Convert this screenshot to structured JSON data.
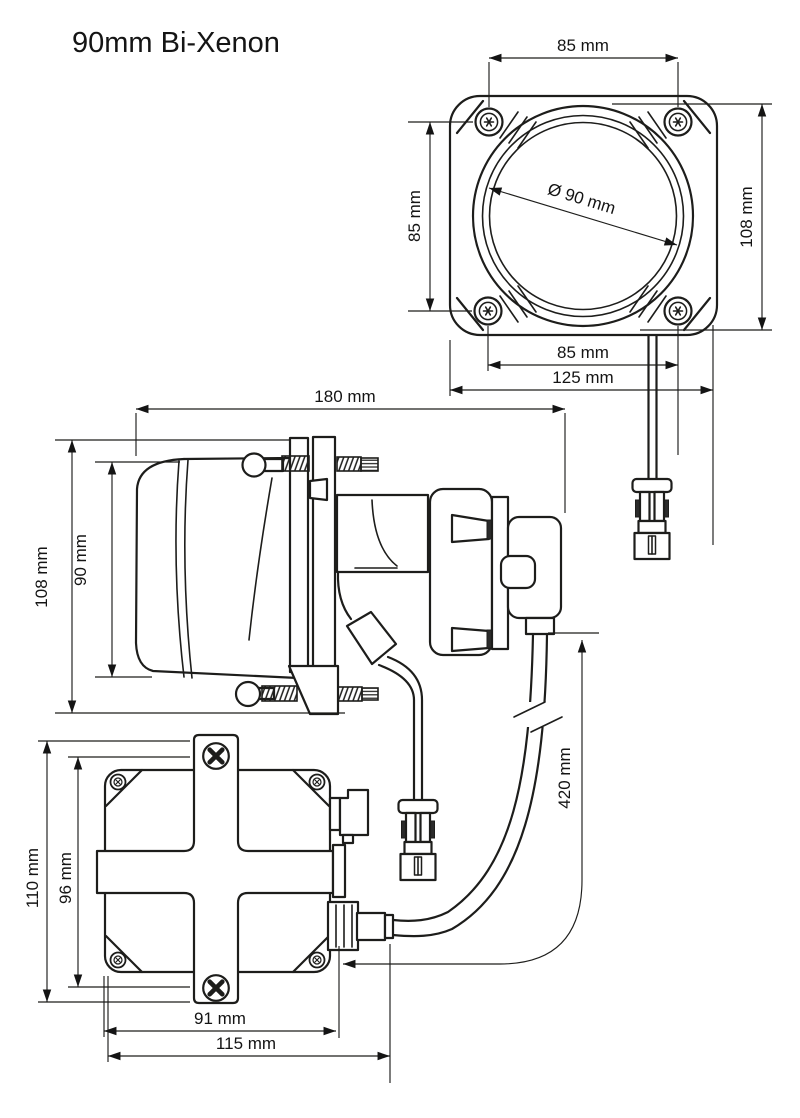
{
  "title": "90mm Bi-Xenon",
  "unit": "mm",
  "colors": {
    "ink": "#1d1d1b",
    "background": "#ffffff"
  },
  "views": {
    "front": {
      "dims": {
        "top_screw_spacing": "85 mm",
        "side_screw_spacing": "85 mm",
        "overall_height": "108 mm",
        "lens_diameter": "Ø 90 mm",
        "bottom_screw_spacing": "85 mm",
        "overall_width": "125 mm"
      }
    },
    "side": {
      "dims": {
        "overall_length": "180 mm",
        "overall_height": "108 mm",
        "body_height": "90 mm",
        "cable_length": "420 mm"
      }
    },
    "ballast": {
      "dims": {
        "overall_height": "110 mm",
        "screw_spacing": "96 mm",
        "body_width": "91 mm",
        "overall_width": "115 mm"
      }
    }
  }
}
